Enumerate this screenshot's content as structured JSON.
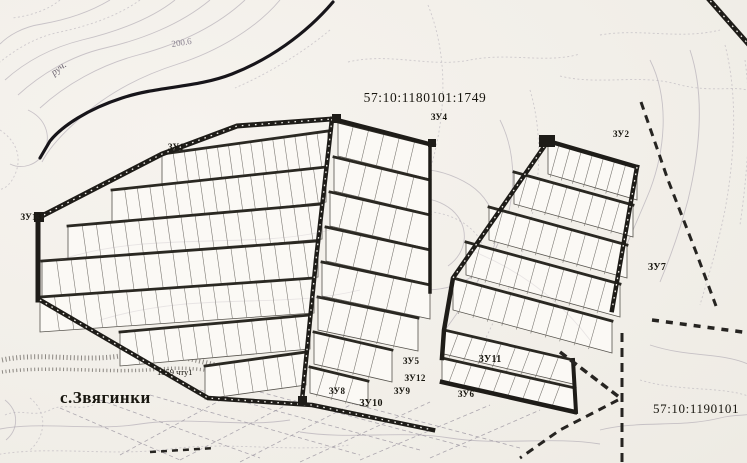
{
  "labels": {
    "cadastral_parcel_top": "57:10:1180101:1749",
    "cadastral_quarter_bottom": "57:10:1190101",
    "village": "с.Звягинки",
    "stream": "руч.",
    "elevation_mark": "200.6",
    "survey_mark": "1559 чту1",
    "parcels": {
      "zu1": "ЗУ1",
      "zu2": "ЗУ2",
      "zu4": "ЗУ4",
      "zu5": "ЗУ5",
      "zu6": "ЗУ6",
      "zu7": "ЗУ7",
      "zu8": "ЗУ8",
      "zu9": "ЗУ9",
      "zu10": "ЗУ10",
      "zu11": "ЗУ11",
      "zu12": "ЗУ12",
      "zu13": "ЗУ13"
    }
  },
  "colors": {
    "paper": "#f2efea",
    "ink": "#1e1c18",
    "contour": "#a49daa",
    "boundary_dash": "#262421"
  }
}
